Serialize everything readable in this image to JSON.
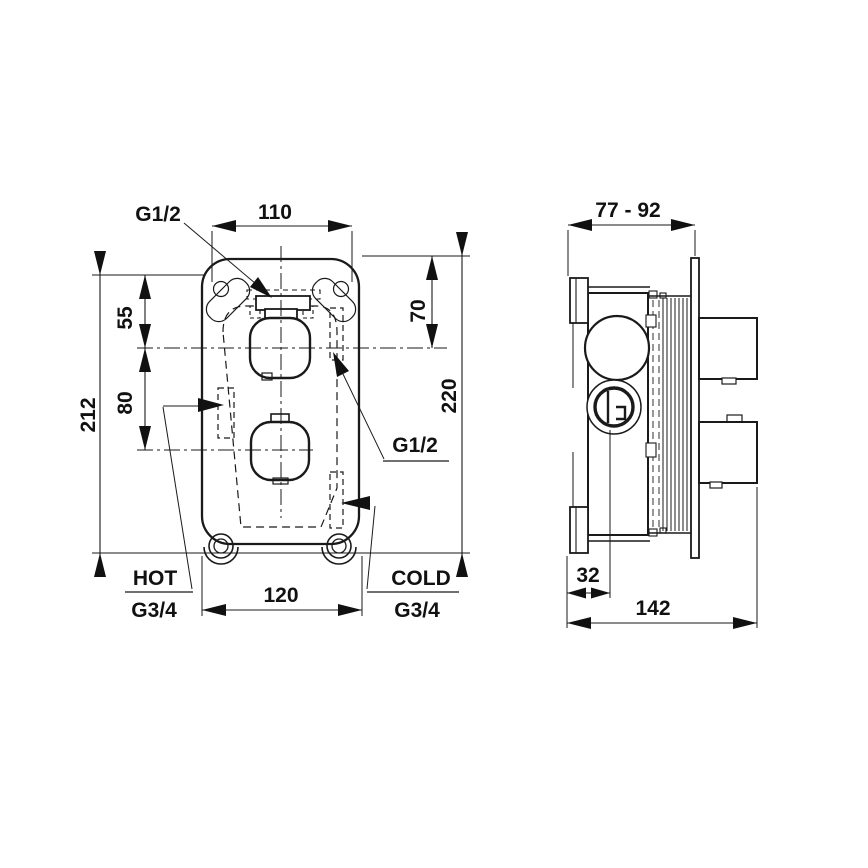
{
  "drawing": {
    "front_view": {
      "top_outlet": "G1/2",
      "side_outlet": "G1/2",
      "width_top": "110",
      "width_bottom": "120",
      "height_overall": "220",
      "height_body": "212",
      "top_to_upper_axis": "70",
      "plate_top_to_upper_axis": "55",
      "upper_to_lower_axis": "80",
      "hot_label": "HOT",
      "hot_thread": "G3/4",
      "cold_label": "COLD",
      "cold_thread": "G3/4"
    },
    "side_view": {
      "install_depth_range": "77 - 92",
      "inlet_axis_offset": "32",
      "overall_depth": "142"
    }
  }
}
